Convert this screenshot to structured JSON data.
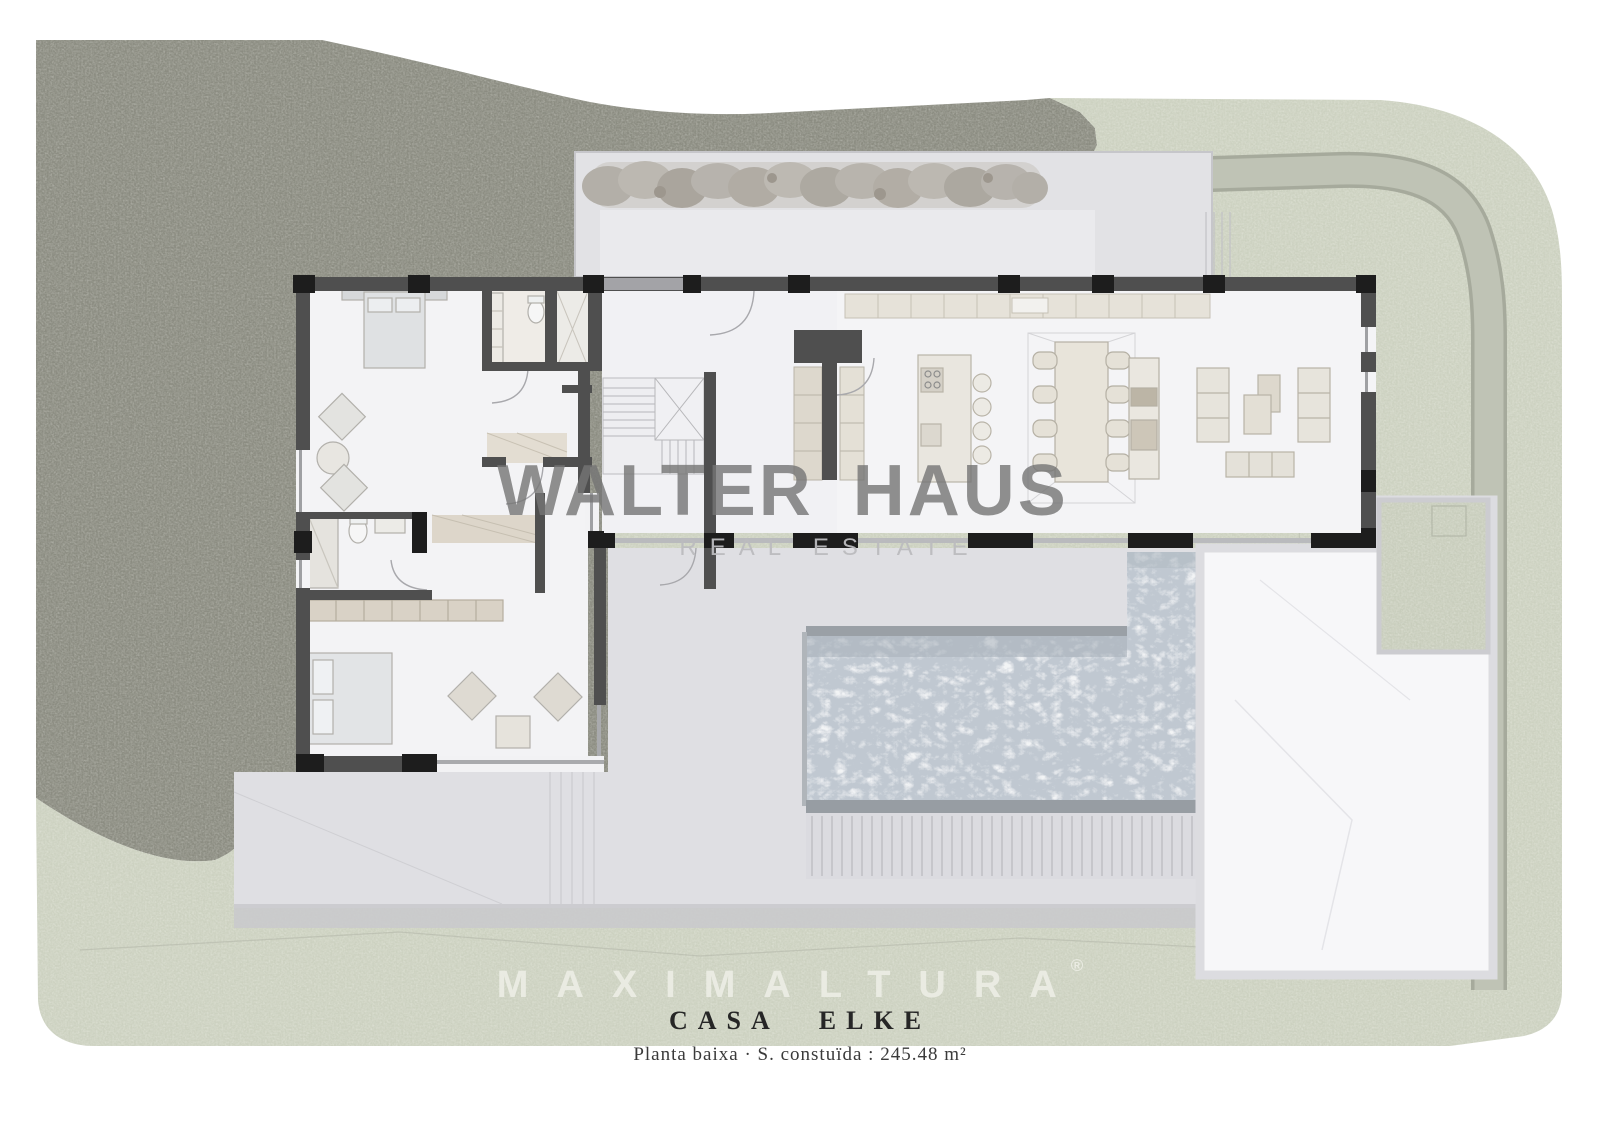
{
  "document": {
    "title": "CASA ELKE",
    "subtitle": "Planta baixa · S. constuïda : 245.48 m²"
  },
  "watermarks": {
    "brand": "WALTER HAUS",
    "brand_sub": "REAL ESTATE",
    "developer": "MAXIMALTURA",
    "registered_mark": "®"
  },
  "palette": {
    "page_background": "#ffffff",
    "terrain_dark_olive": "#8b8c81",
    "terrain_light_green": "#ccd1c0",
    "road_gray": "#bfc3b5",
    "courtyard_gray": "#e2e2e5",
    "terrace_gray": "#dfdfe3",
    "wall_dark": "#4f4f4f",
    "column_black": "#1d1d1d",
    "pool_water_blue": "#c0c8d1",
    "patio_white": "#f7f7f9",
    "wood_beige": "#d9d2c6",
    "brand_watermark_gray": "#757575",
    "developer_watermark_cream": "#edeee6"
  }
}
